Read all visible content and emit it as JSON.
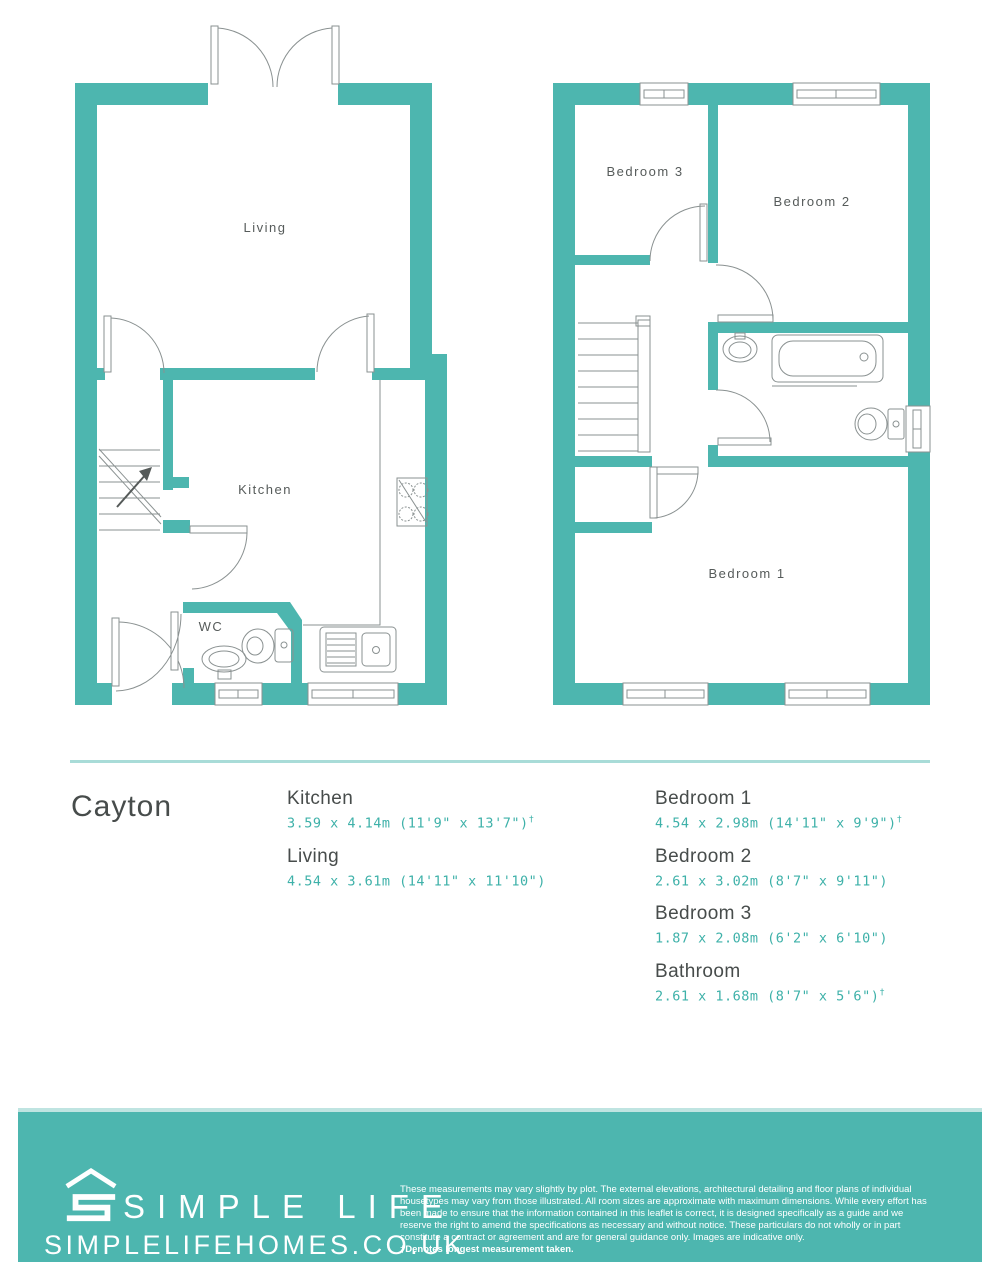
{
  "colors": {
    "wall_teal": "#4db6af",
    "divider_teal": "#a9dcd8",
    "heading_gray": "#474c4b",
    "dimension_teal": "#3eb1a9",
    "plan_line_gray": "#8a9191",
    "footer_background": "#4db6af"
  },
  "plan_name": "Cayton",
  "floorplan": {
    "ground": {
      "living": "Living",
      "kitchen": "Kitchen",
      "wc": "WC"
    },
    "first": {
      "bedroom1": "Bedroom 1",
      "bedroom2": "Bedroom 2",
      "bedroom3": "Bedroom 3"
    }
  },
  "dimensions": {
    "left": [
      {
        "room": "Kitchen",
        "size": "3.59 x 4.14m (11'9\" x 13'7\")",
        "dagger": "†"
      },
      {
        "room": "Living",
        "size": "4.54 x 3.61m (14'11\" x 11'10\")",
        "dagger": ""
      }
    ],
    "right": [
      {
        "room": "Bedroom 1",
        "size": "4.54 x 2.98m (14'11\" x 9'9\")",
        "dagger": "†"
      },
      {
        "room": "Bedroom 2",
        "size": "2.61 x 3.02m (8'7\" x 9'11\")",
        "dagger": ""
      },
      {
        "room": "Bedroom 3",
        "size": "1.87 x 2.08m (6'2\" x 6'10\")",
        "dagger": ""
      },
      {
        "room": "Bathroom",
        "size": "2.61 x 1.68m (8'7\" x 5'6\")",
        "dagger": "†"
      }
    ]
  },
  "footer": {
    "brand": "SIMPLE LIFE",
    "website": "SIMPLELIFEHOMES.CO.UK",
    "disclaimer": "These measurements may vary slightly by plot. The external elevations, architectural detailing and floor plans of individual housetypes may vary from those illustrated. All room sizes are approximate with maximum dimensions. While every effort has been made to ensure that the information contained in this leaflet is correct, it is designed specifically as a guide and we reserve the right to amend the specifications as necessary and without notice. These particulars do not wholly or in part constitute a contract or agreement and are for general guidance only. Images are indicative only.",
    "disclaimer_bold": "†Denotes longest measurement taken."
  }
}
